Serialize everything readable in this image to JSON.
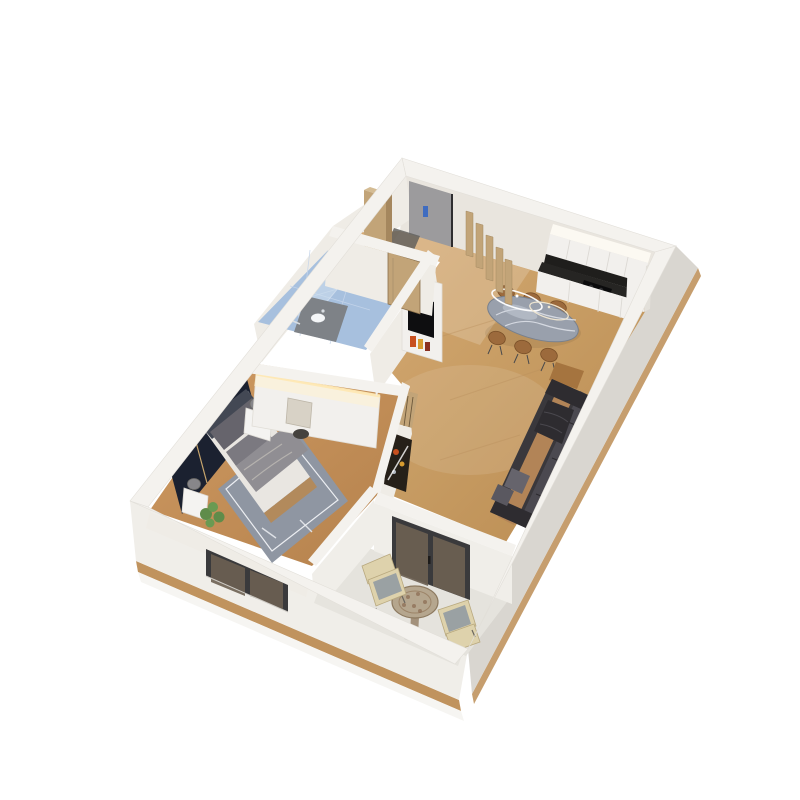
{
  "title": "3d-isometric-floor-plan-render",
  "colors": {
    "bg": "#ffffff",
    "wall_top": "#f4f2ee",
    "wall_face_light": "#f0eee9",
    "wall_face_shadow": "#d9d6d0",
    "wall_inner_warm": "#e9e5de",
    "wall_inner_light": "#efece6",
    "slab_wood": "#c0935e",
    "wood_floor": "#c79c63",
    "wood_floor_light": "#ddb684",
    "bedroom_floor": "#bf8c57",
    "balcony_floor": "#e5e3dd",
    "tile_blue": "#a7c0de",
    "glass_blue": "#cfe0ef",
    "glass_dark": "#6d6152",
    "frame_dark": "#3a3a3c",
    "door_gray": "#9c9b9d",
    "handle_blue": "#3f6cc0",
    "wood_tan": "#c2a478",
    "wood_tan_dark": "#a5875e",
    "counter_dark": "#262523",
    "cabinet_white": "#f2f0ed",
    "soffit_white": "#fcf9f2",
    "led_warm": "#ffe9b5",
    "marble_table": "#99a0ac",
    "marble_vein": "#dfe3ea",
    "chair_brown": "#9c6a3c",
    "chair_brown_dark": "#7a5028",
    "sofa_dark": "#3a383c",
    "sofa_dark2": "#2e2c30",
    "sofa_cushion": "#4b4950",
    "sofa_tan": "#b28457",
    "pillow_gray": "#66646c",
    "headboard_navy": "#1b2130",
    "gold_trim": "#c8a66d",
    "bedding_light": "#e9e6e1",
    "bedding_gray": "#908e93",
    "bed_frame_tan": "#b28a5c",
    "headboard_gray": "#434854",
    "rug_gray": "#8f96a2",
    "rug_pattern": "#eceef2",
    "plant_green": "#5f8c4a",
    "plant_green2": "#6a9a52",
    "mat_gray": "#63615e",
    "vanity_marble": "#7e8287",
    "art_dark": "#262019",
    "art_accent": "#c8501f",
    "art_accent2": "#d79b2f",
    "chrome": "#d9dee3",
    "tv_black": "#0e0e10",
    "stool_dark": "#45423e",
    "chair_cream": "#ded2ac",
    "chair_cushion": "#9aa1a3",
    "mosaic_tan": "#b5a68e",
    "mosaic_dot": "#8d6e55"
  },
  "scene": {
    "view": "rotated-isometric-apartment-render",
    "rooms": [
      {
        "id": "entry-hall",
        "floor": "wood",
        "features": [
          "entrance-door",
          "wardrobe",
          "doormat",
          "slat-divider"
        ]
      },
      {
        "id": "kitchen",
        "floor": "wood",
        "features": [
          "soffit-light",
          "upper-cabinets",
          "backsplash",
          "countertop",
          "cooktop",
          "tall-cabinet"
        ]
      },
      {
        "id": "dining-area",
        "floor": "wood",
        "features": [
          "marble-oval-table",
          "six-chairs",
          "wire-pendant-light"
        ]
      },
      {
        "id": "living-room",
        "floor": "wood",
        "features": [
          "sectional-sofa",
          "throw-blanket",
          "cushions",
          "side-table",
          "tv-media-unit",
          "art-panel"
        ]
      },
      {
        "id": "bathroom",
        "floor": "blue-tile",
        "features": [
          "glass-shower",
          "marble-vanity",
          "sink",
          "wood-door"
        ]
      },
      {
        "id": "bedroom",
        "floor": "wood",
        "features": [
          "double-bed",
          "headboard-wall-panels",
          "cove-light",
          "nightstands",
          "table-lamps",
          "rug",
          "plant",
          "vanity-unit",
          "stool",
          "window"
        ]
      },
      {
        "id": "balcony",
        "floor": "concrete",
        "features": [
          "glass-doors",
          "round-mosaic-table",
          "two-armchairs",
          "parapet-walls"
        ]
      }
    ]
  }
}
